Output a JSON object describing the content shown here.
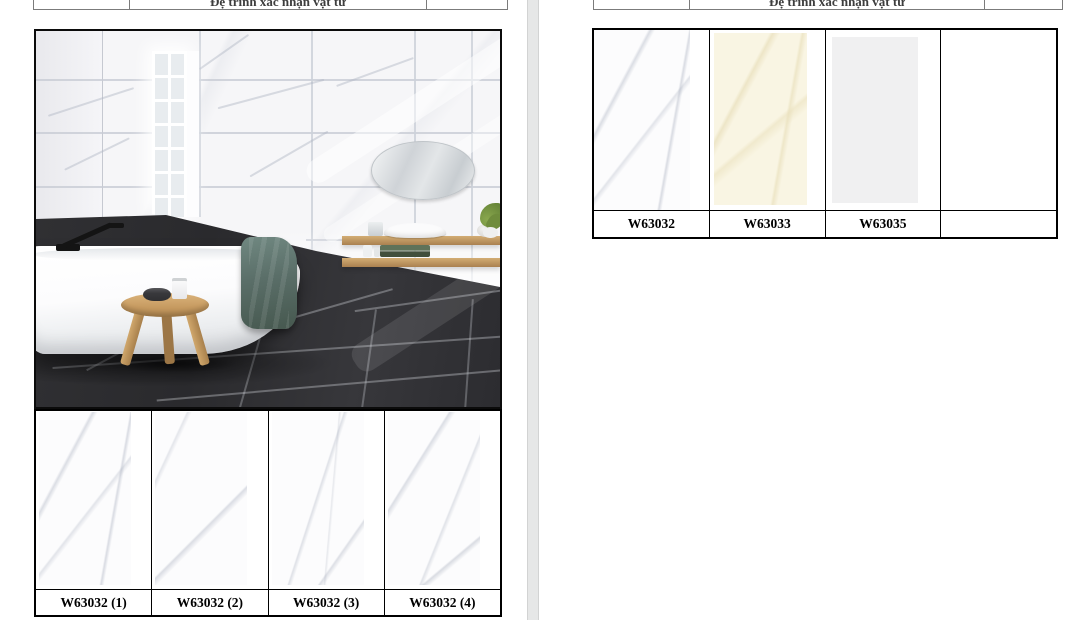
{
  "pages": [
    {
      "header": {
        "left_cell": "",
        "title": "Đệ trình xác nhận vật tư",
        "right_cell": ""
      },
      "photo_alt": "Bathroom with white marble tiled walls, tall window, oval mirror, freestanding white bathtub with black faucet, green towel draped on tub, wooden stool and floating shelves, dark grey tiled floor",
      "samples": [
        {
          "label": "W63032 (1)"
        },
        {
          "label": "W63032 (2)"
        },
        {
          "label": "W63032 (3)"
        },
        {
          "label": "W63032 (4)"
        }
      ]
    },
    {
      "header": {
        "left_cell": "",
        "title": "Đệ trình xác nhận vật tư",
        "right_cell": ""
      },
      "samples": [
        {
          "label": "W63032",
          "tile_color": "#fbfbfd",
          "finish": "white marble"
        },
        {
          "label": "W63033",
          "tile_color": "#f9f5e3",
          "finish": "cream"
        },
        {
          "label": "W63035",
          "tile_color": "#f0f0f1",
          "finish": "light grey"
        },
        {
          "label": "",
          "tile_color": "",
          "finish": "empty"
        }
      ]
    }
  ],
  "colors": {
    "table_border": "#000000",
    "header_border": "#7b7b7b",
    "header_text": "#3d3d3d",
    "label_text": "#000000",
    "page_background": "#ffffff",
    "page_gap": "#e6e7e7",
    "floor_dark": "#2b2b2e",
    "wood": "#c49a62",
    "towel_teal": "#5a6e68"
  }
}
